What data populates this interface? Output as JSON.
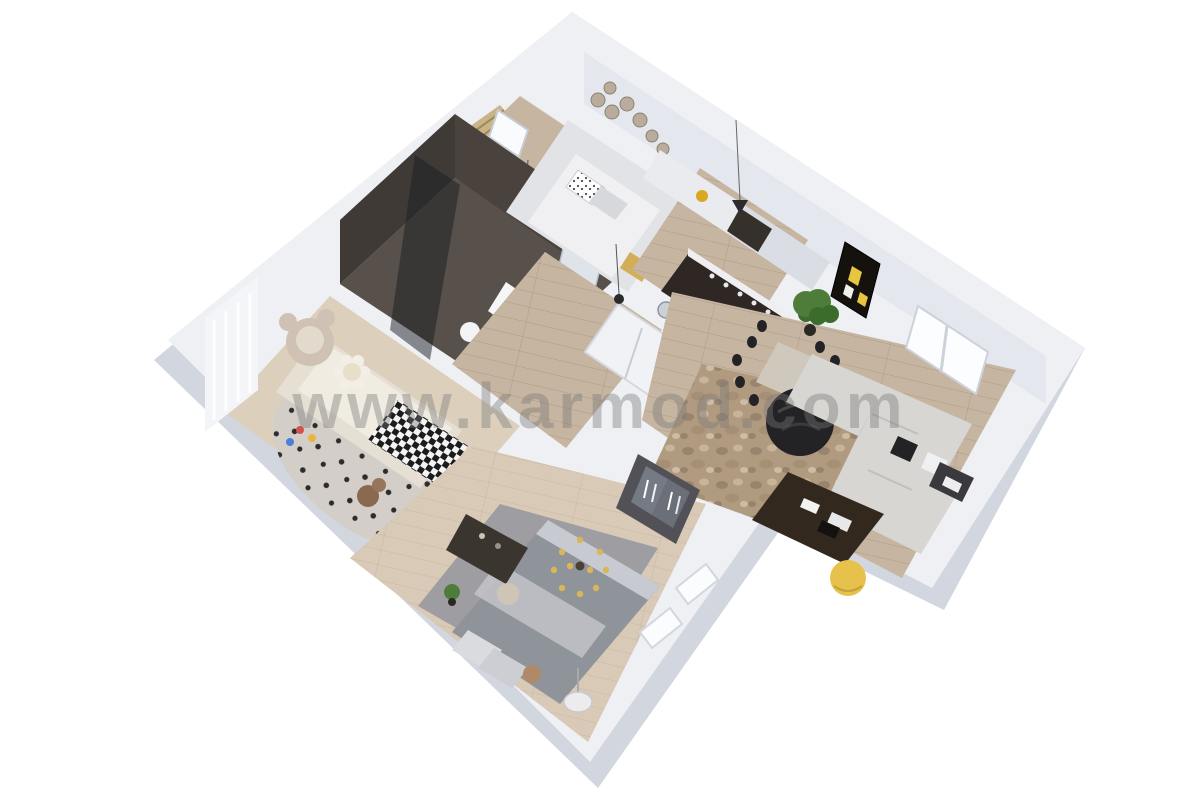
{
  "watermark": {
    "text": "www.karmod.com"
  },
  "palette": {
    "background": "#ffffff",
    "wall_top": "#eef0f4",
    "wall_face_shaded": "#dde0e8",
    "wall_face_dark": "#d2d6df",
    "wood_floor": "#c6b5a0",
    "wood_floor_light": "#d8cab6",
    "tile_dark": "#57504b",
    "tile_wall_dark": "#3f3a36",
    "island_dark": "#2f2723",
    "sofa_gray": "#d8d6d3",
    "bed_gray": "#8f939a",
    "rug_master": "#9b9ba1",
    "rug_living_base": "#b19b80",
    "accent_yellow": "#e6c14b",
    "plant_green": "#4e7d3a",
    "chair_black": "#232326",
    "bear_beige": "#cfc2b4"
  }
}
